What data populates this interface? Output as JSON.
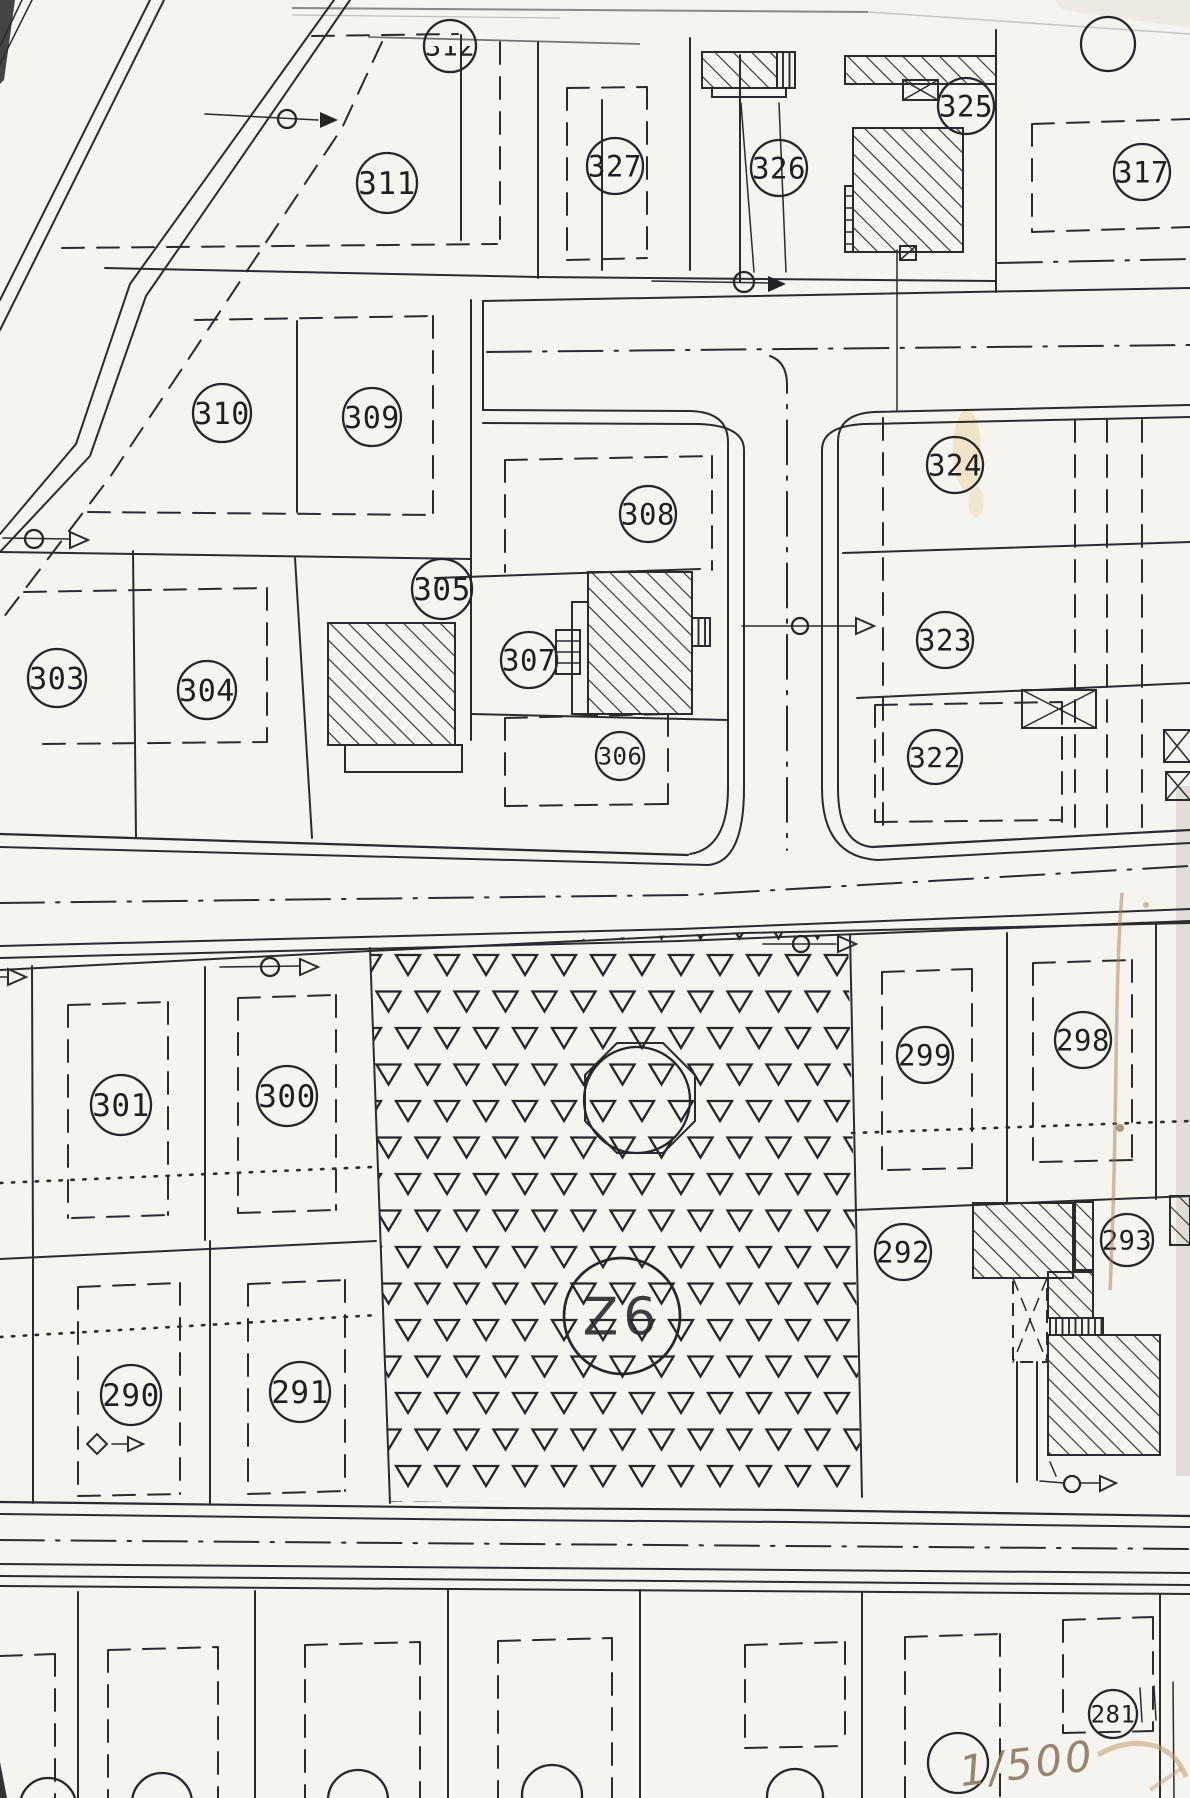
{
  "map": {
    "scale_note": "1/500",
    "zone": {
      "label": "Z6",
      "x": 622,
      "y": 1316,
      "r": 58
    },
    "parcels": [
      {
        "label": "312",
        "x": 450,
        "y": 46,
        "r": 26,
        "clip": true
      },
      {
        "label": "311",
        "x": 387,
        "y": 183,
        "r": 30
      },
      {
        "label": "327",
        "x": 615,
        "y": 166,
        "r": 28
      },
      {
        "label": "326",
        "x": 779,
        "y": 168,
        "r": 28
      },
      {
        "label": "325",
        "x": 966,
        "y": 106,
        "r": 28
      },
      {
        "label": "317",
        "x": 1142,
        "y": 172,
        "r": 28
      },
      {
        "label": "310",
        "x": 222,
        "y": 413,
        "r": 29
      },
      {
        "label": "309",
        "x": 372,
        "y": 417,
        "r": 29
      },
      {
        "label": "308",
        "x": 648,
        "y": 514,
        "r": 28
      },
      {
        "label": "324",
        "x": 955,
        "y": 465,
        "r": 28
      },
      {
        "label": "305",
        "x": 442,
        "y": 589,
        "r": 30
      },
      {
        "label": "303",
        "x": 57,
        "y": 678,
        "r": 29
      },
      {
        "label": "304",
        "x": 207,
        "y": 690,
        "r": 29
      },
      {
        "label": "307",
        "x": 529,
        "y": 660,
        "r": 28
      },
      {
        "label": "323",
        "x": 945,
        "y": 640,
        "r": 28
      },
      {
        "label": "306",
        "x": 620,
        "y": 756,
        "r": 24
      },
      {
        "label": "322",
        "x": 935,
        "y": 757,
        "r": 27
      },
      {
        "label": "301",
        "x": 121,
        "y": 1105,
        "r": 30
      },
      {
        "label": "300",
        "x": 287,
        "y": 1096,
        "r": 30
      },
      {
        "label": "299",
        "x": 925,
        "y": 1055,
        "r": 28
      },
      {
        "label": "298",
        "x": 1083,
        "y": 1040,
        "r": 28
      },
      {
        "label": "290",
        "x": 131,
        "y": 1395,
        "r": 30
      },
      {
        "label": "291",
        "x": 300,
        "y": 1392,
        "r": 30
      },
      {
        "label": "292",
        "x": 903,
        "y": 1252,
        "r": 28
      },
      {
        "label": "293",
        "x": 1127,
        "y": 1240,
        "r": 26
      },
      {
        "label": "281",
        "x": 1113,
        "y": 1714,
        "r": 24
      }
    ],
    "unlabeled_circles": [
      {
        "x": 1108,
        "y": 44,
        "r": 27
      }
    ],
    "symbols": [
      "survey-point-arrow-icon",
      "crossed-box-icon",
      "diamond-marker-icon",
      "octagon-structure",
      "triangle-vegetation-pattern"
    ],
    "colors": {
      "ink": "#2b2b2b",
      "paper": "#f6f4ef",
      "pencil": "#8f7a5f",
      "stain": "#a87c4a"
    }
  }
}
